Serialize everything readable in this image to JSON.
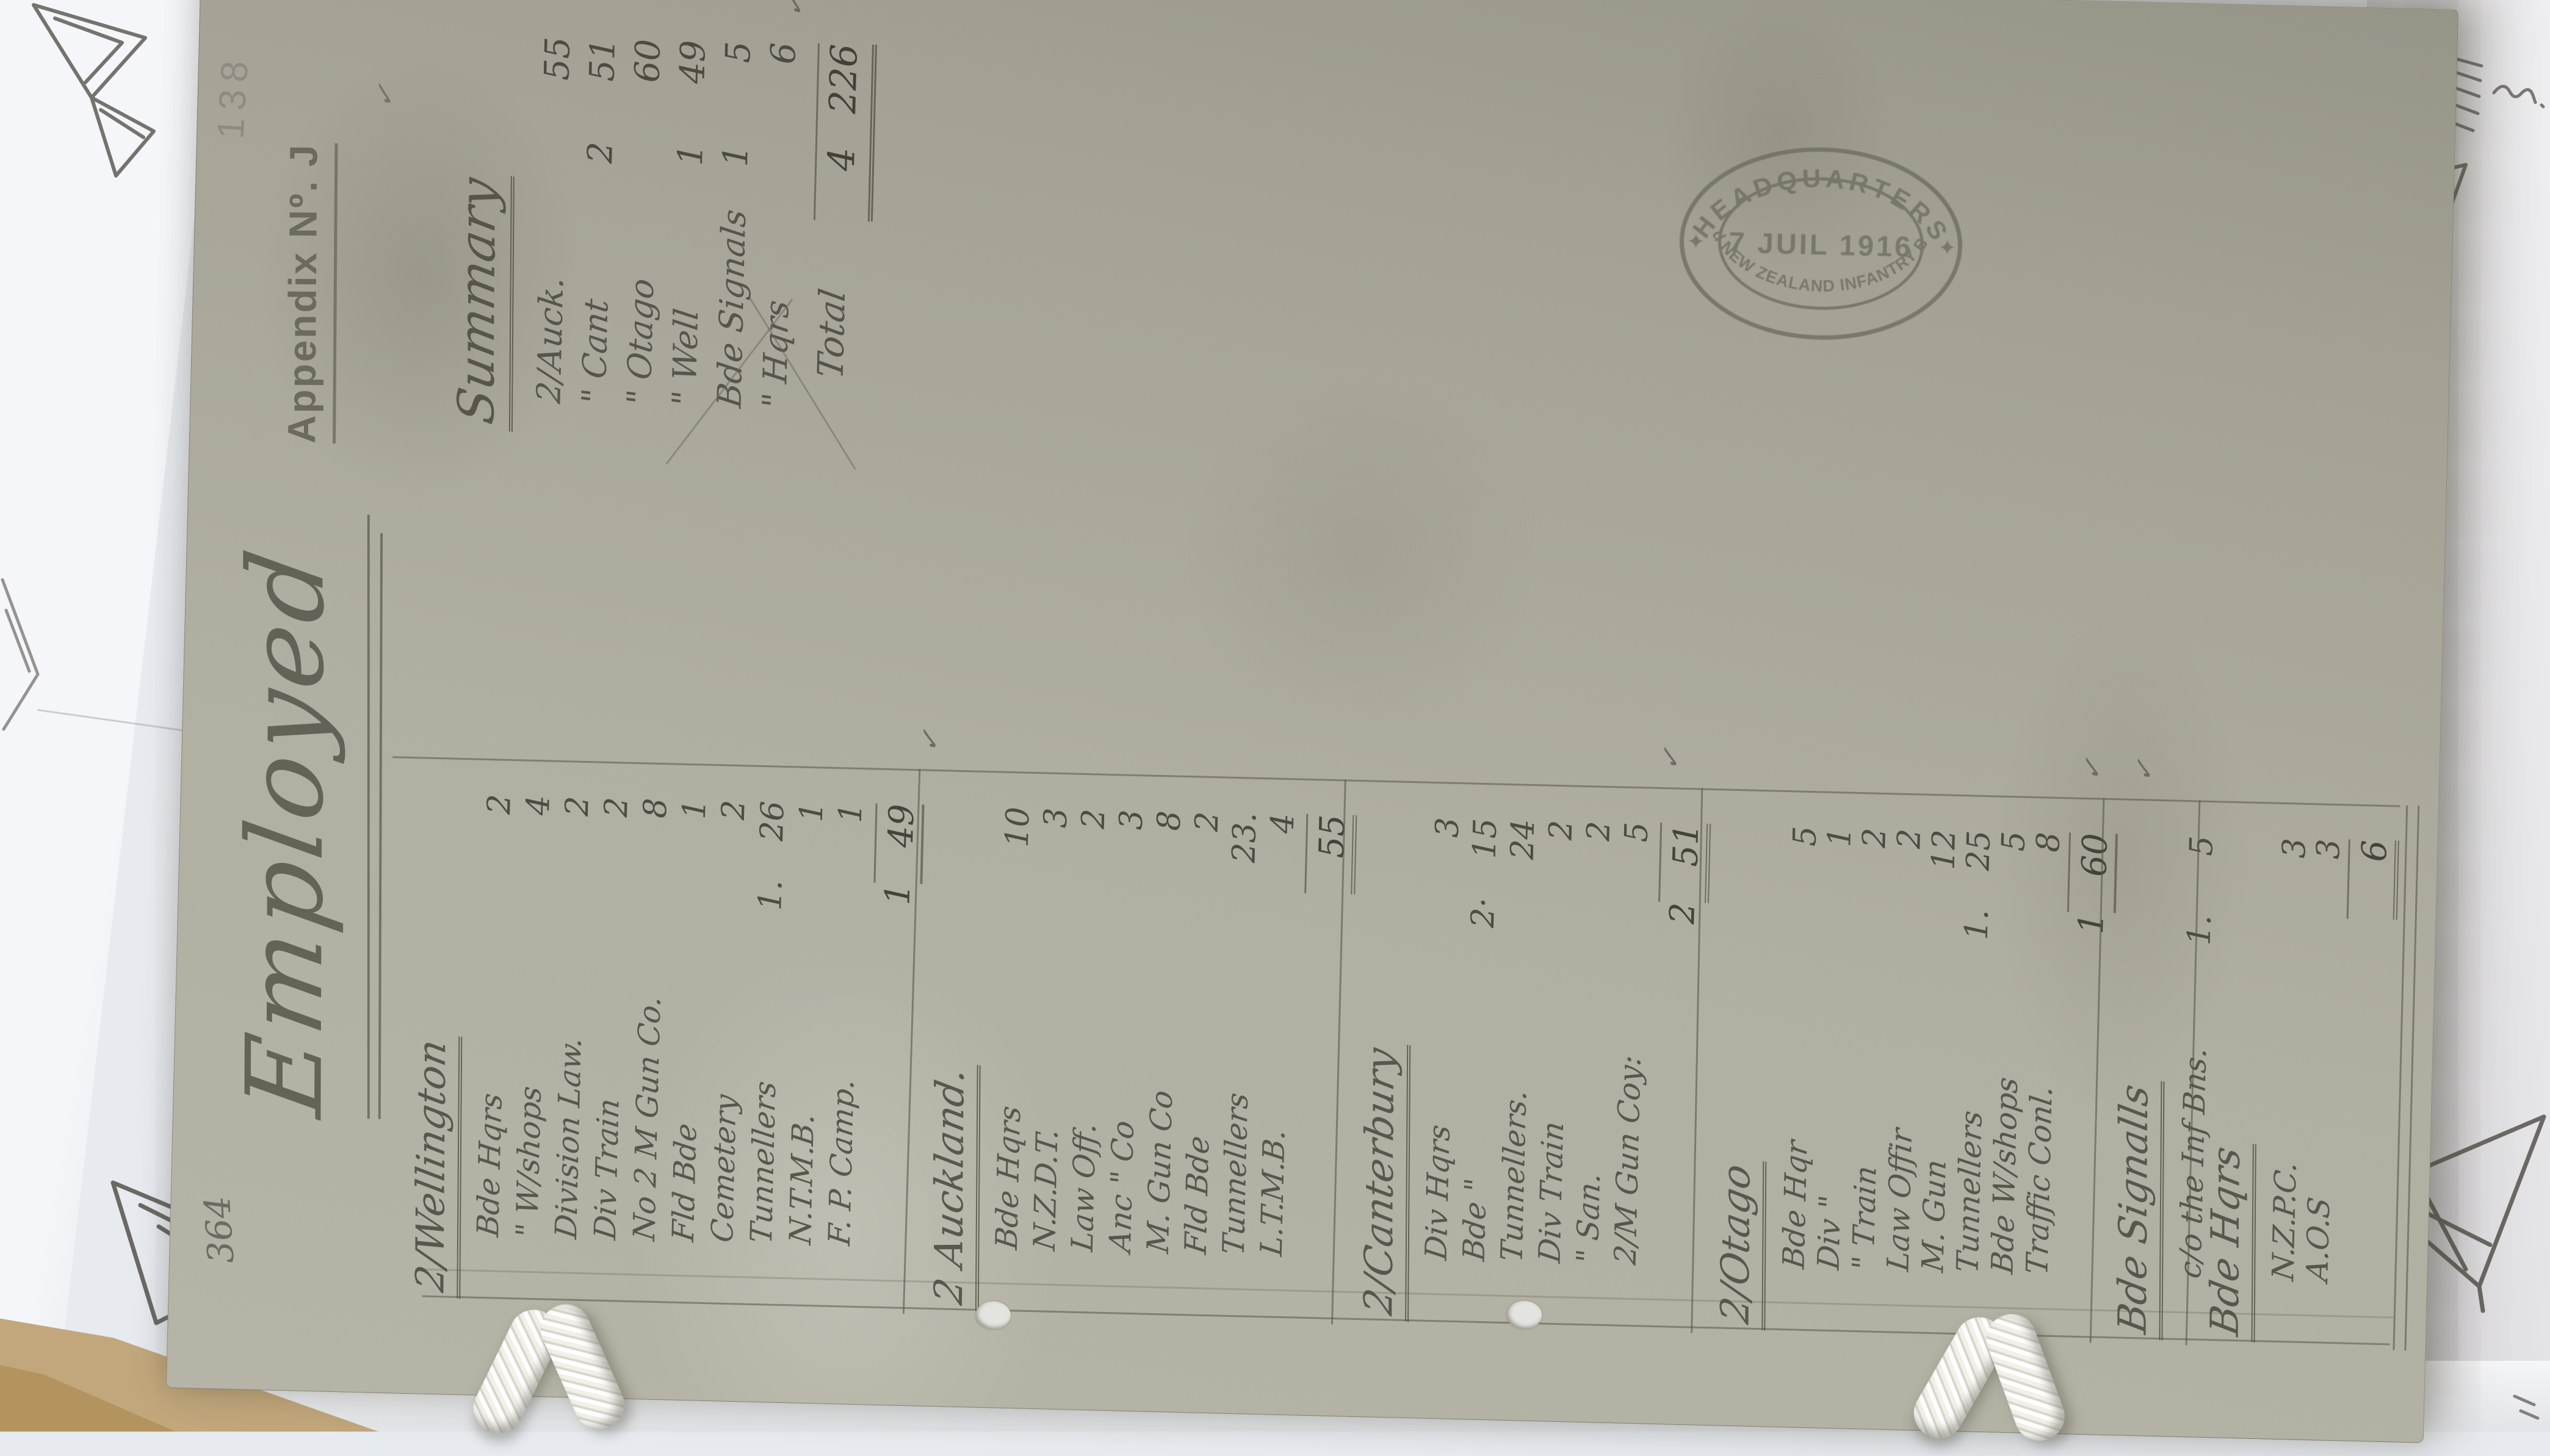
{
  "colors": {
    "paper": "#aeac9e",
    "ink": "#504f44",
    "pencil": "#55534c",
    "stamp": "#6d6d60",
    "white_sheet": "#f1f3f6",
    "tan_sheet": "#c2a77c"
  },
  "page": {
    "file_number": "364",
    "sheet_number": "138",
    "appendix_label": "Appendix Nº. J",
    "title": "Employed",
    "appendix_tick": "✓"
  },
  "stamp": {
    "arc_top": "HEADQUARTERS",
    "date": "7 JUIL 1916",
    "arc_bottom": "2nd NEW ZEALAND INFANTRY BDE",
    "star_left": "✦",
    "star_right": "✦"
  },
  "summary": {
    "heading": "Summary",
    "rows": [
      [
        "2/Auck.",
        "",
        "55"
      ],
      [
        "\" Cant",
        "2",
        "51"
      ],
      [
        "\" Otago",
        "",
        "60"
      ],
      [
        "\" Well",
        "1",
        "49"
      ],
      [
        "Bde Signals",
        "1",
        "5"
      ],
      [
        "\" Hqrs",
        "",
        "6"
      ]
    ],
    "total_label": "Total",
    "total_inner": "4",
    "total_value": "226",
    "tick": "✓"
  },
  "sections": [
    {
      "heading": "2/Wellington",
      "rows": [
        [
          "Bde Hqrs",
          "",
          "2"
        ],
        [
          "\" W/shops",
          "",
          "4"
        ],
        [
          "Division Law.",
          "",
          "2"
        ],
        [
          "Div Train",
          "",
          "2"
        ],
        [
          "No 2 M Gun Co.",
          "",
          "8"
        ],
        [
          "Fld Bde",
          "",
          "1"
        ],
        [
          "Cemetery",
          "",
          "2"
        ],
        [
          "Tunnellers",
          "1.",
          "26"
        ],
        [
          "N.T.M.B.",
          "",
          "1"
        ],
        [
          "F. P. Camp.",
          "",
          "1"
        ]
      ],
      "total_inner": "1",
      "total": "49",
      "tick": "✓"
    },
    {
      "heading": "2 Auckland.",
      "rows": [
        [
          "Bde Hqrs",
          "",
          "10"
        ],
        [
          "N.Z.D.T.",
          "",
          "3"
        ],
        [
          "Law Off.",
          "",
          "2"
        ],
        [
          "Anc \" Co",
          "",
          "3"
        ],
        [
          "M. Gun Co",
          "",
          "8"
        ],
        [
          "Fld Bde",
          "",
          "2"
        ],
        [
          "Tunnellers",
          "",
          "23."
        ],
        [
          "L.T.M.B.",
          "",
          "4"
        ]
      ],
      "total_inner": "",
      "total": "55",
      "tick": ""
    },
    {
      "heading": "2/Canterbury",
      "rows": [
        [
          "Div Hqrs",
          "",
          "3"
        ],
        [
          "Bde \"",
          "2·",
          "15"
        ],
        [
          "Tunnellers.",
          "",
          "24"
        ],
        [
          "Div Train",
          "",
          "2"
        ],
        [
          "\" San.",
          "",
          "2"
        ],
        [
          "2/M Gun Coy:",
          "",
          "5"
        ]
      ],
      "total_inner": "2",
      "total": "51",
      "tick": "✓"
    },
    {
      "heading": "2/Otago",
      "rows": [
        [
          "Bde Hqr",
          "",
          "5"
        ],
        [
          "Div \"",
          "",
          "1"
        ],
        [
          "\" Train",
          "",
          "2"
        ],
        [
          "Law Offir",
          "",
          "2"
        ],
        [
          "M. Gun",
          "",
          "12"
        ],
        [
          "Tunnellers",
          "1.",
          "25"
        ],
        [
          "Bde W/shops",
          "",
          "5"
        ],
        [
          "Traffic Conl.",
          "",
          "8"
        ]
      ],
      "total_inner": "1",
      "total": "60",
      "tick": "✓"
    },
    {
      "heading": "Bde Signalls",
      "rows": [
        [
          "c/o the Inf Bns.",
          "1.",
          "5"
        ]
      ],
      "total_inner": "",
      "total": "",
      "tick": "✓"
    },
    {
      "heading": "Bde Hqrs",
      "rows": [
        [
          "N.Z.P.C.",
          "",
          "3"
        ],
        [
          "A.O.S",
          "",
          "3"
        ]
      ],
      "total_inner": "",
      "total": "6",
      "tick": ""
    }
  ]
}
